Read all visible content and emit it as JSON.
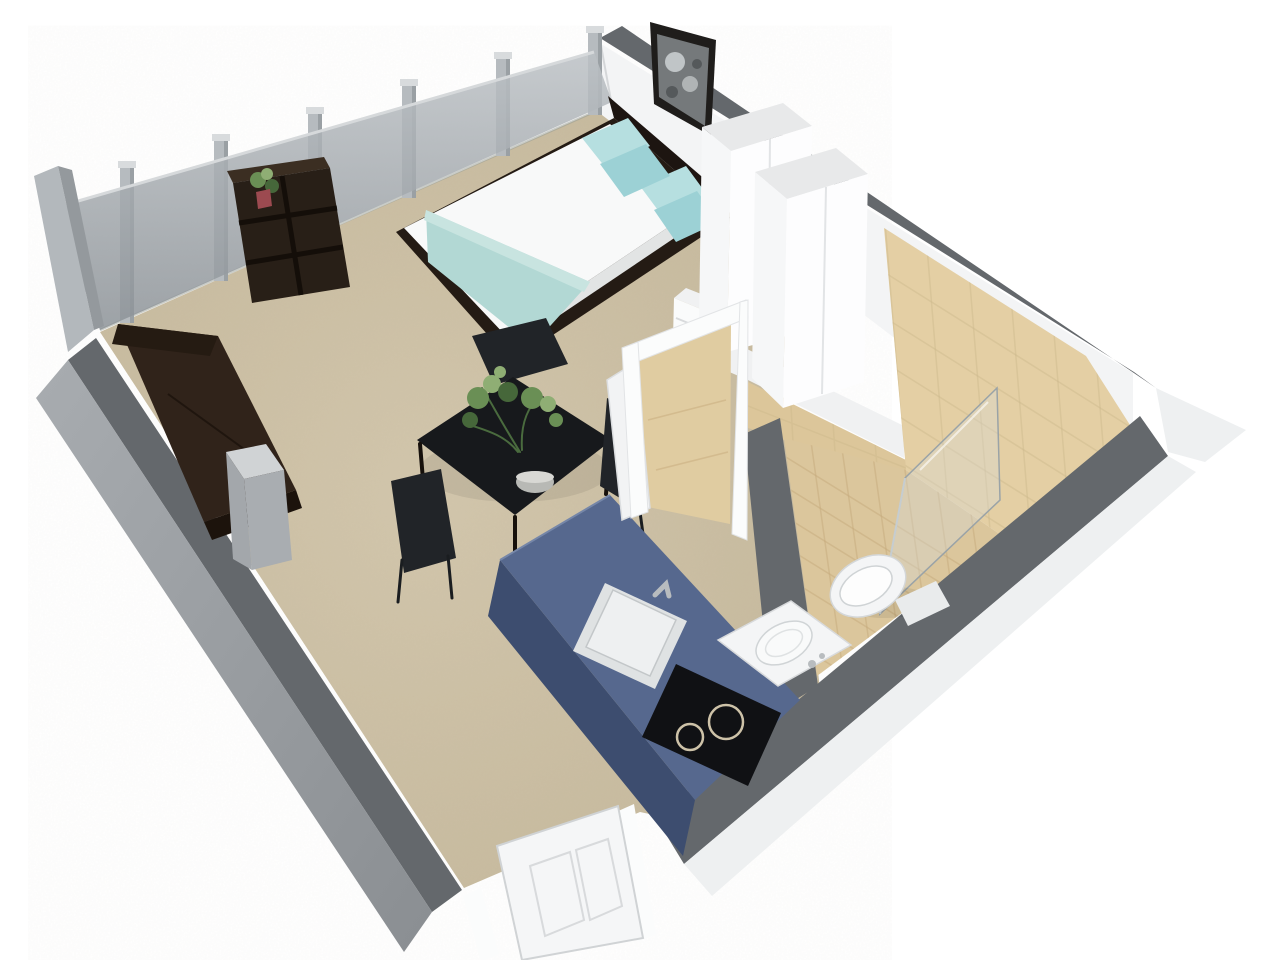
{
  "meta": {
    "title": "3D studio apartment floor plan render",
    "type": "isometric-3d-floorplan",
    "background": "#ffffff"
  },
  "rooms": [
    {
      "name": "living-sleeping-area",
      "furniture": [
        "double bed with dark frame",
        "white mattress",
        "aqua duvet",
        "four aqua pillows",
        "dark headboard",
        "framed wall picture",
        "white two-door wardrobe",
        "white nightstand",
        "dark cube shelf with plant",
        "dark brown sofa",
        "gray side table",
        "black dining table",
        "three dark chairs",
        "potted plant centerpiece"
      ]
    },
    {
      "name": "kitchenette",
      "furniture": [
        "blue kitchen counter",
        "inset white sink with faucet",
        "black two-ring cooktop"
      ]
    },
    {
      "name": "bathroom",
      "furniture": [
        "beige floor tiles",
        "beige wall tiles",
        "toilet",
        "square washbasin",
        "glass shower screen",
        "open white door with frame"
      ]
    },
    {
      "name": "structure",
      "furniture": [
        "glass curtain wall with pillars",
        "gray perimeter walls",
        "white entry door",
        "white partition walls"
      ]
    }
  ],
  "palette": {
    "background": "#ffffff",
    "wall_top": "#64686c",
    "wall_outer_light": "#9aa0a5",
    "wall_white": "#f3f4f5",
    "wall_white_outer": "#eef0f1",
    "partition_white": "#f0f1f2",
    "corner_column": "#b3b8bc",
    "corner_column_shade": "#94999d",
    "glass_pillar": "#b6bbbf",
    "pillar_cap": "#d8dbdd",
    "pillar_shade": "#9aa0a4",
    "carpet": "#cbbfa4",
    "tile_wall": "#e4cfa4",
    "tile_wall_shaded": "#dcc69a",
    "tile_floor": "#dbc69c",
    "tile_floor_light": "#e0cca1",
    "bed_frame": "#241b14",
    "headboard": "#1d1511",
    "mattress": "#f8f9f9",
    "mattress_shade": "#e2e4e4",
    "duvet": "#b2d8d4",
    "duvet_drape": "#a6cfcb",
    "pillow_front": "#9cd1d5",
    "pillow_back": "#b6dfe0",
    "wardrobe_top": "#e8e9ea",
    "wardrobe_front": "#f6f7f8",
    "wardrobe_side": "#fdfdfe",
    "nightstand_front": "#fafbfb",
    "nightstand_top": "#f0f1f2",
    "nightstand_side": "#e8eaeb",
    "shelf_front": "#281f17",
    "shelf_top": "#3b2e22",
    "plant_green_mid": "#6a8f55",
    "plant_green_light": "#8fae74",
    "plant_green_dark": "#46673a",
    "plant_pot": "#b8b9b5",
    "vase_red": "#9c4a50",
    "sofa": "#30231a",
    "sofa_back": "#251b12",
    "sofa_arm": "#1c130c",
    "side_table_top": "#d0d3d5",
    "side_table_front": "#a9adb1",
    "side_table_side": "#a3a7ab",
    "dining_table": "#17191c",
    "chair": "#212428",
    "counter_top": "#56688e",
    "counter_front": "#3d4d6f",
    "sink_rim": "#dfe2e3",
    "sink_basin": "#eef0f1",
    "faucet_gray": "#b8bcbf",
    "cooktop": "#101114",
    "cooktop_ring": "#cdc2a8",
    "entry_door": "#f5f6f7",
    "door_frame": "#fbfcfc",
    "toilet_white": "#f4f5f6",
    "fixture_rim": "#e9ebec",
    "shower_glass": "#d7dee0",
    "picture_frame": "#1f1d1b",
    "picture_image": "#75797b",
    "picture_flower": "#c9cdcf"
  }
}
